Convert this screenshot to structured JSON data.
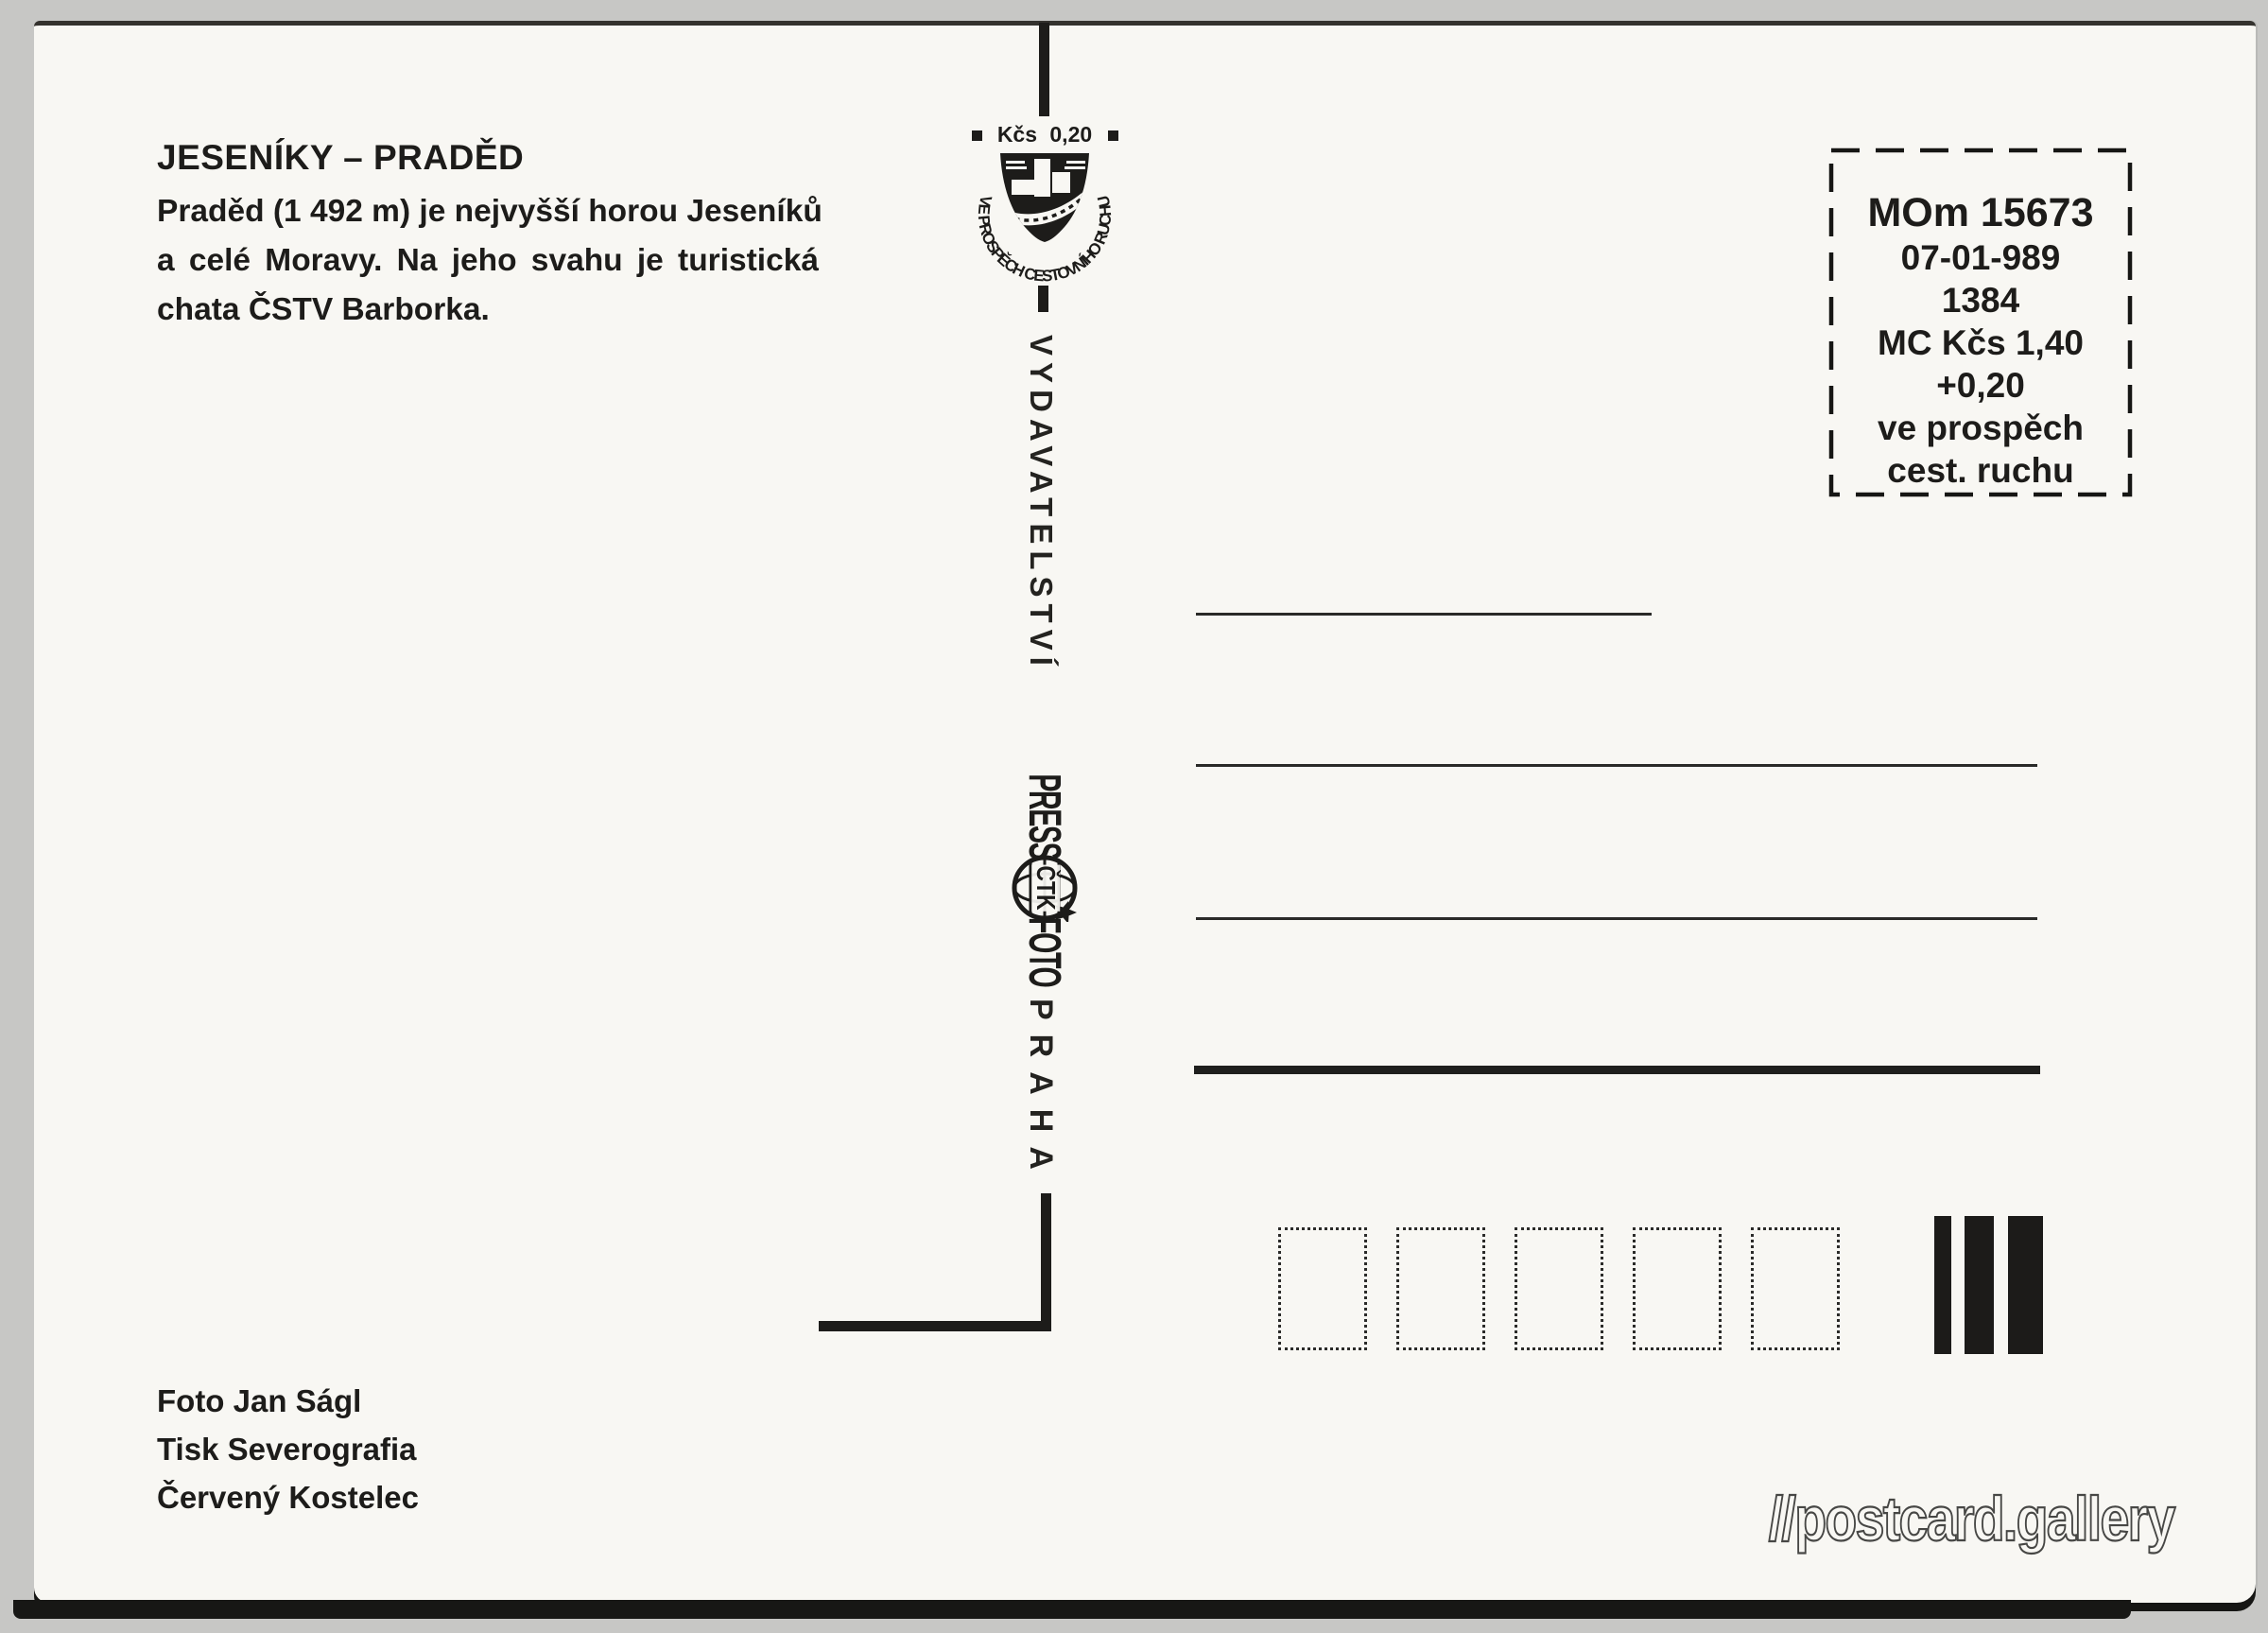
{
  "postcard": {
    "title": "JESENÍKY – PRADĚD",
    "description_lines": [
      "Praděd (1 492 m) je nejvyšší horou Jeseníků",
      "a celé Moravy. Na jeho svahu je turistická",
      "chata ČSTV Barborka."
    ],
    "credits": [
      "Foto Jan Ságl",
      "Tisk Severografia",
      "Červený Kostelec"
    ],
    "divider": {
      "stamp": {
        "value": "Kčs 0,20",
        "arc_text": "VE PROSPĚCH CESTOVNÍHO RUCHU"
      },
      "publisher": "VYDAVATELSTVÍ",
      "press_logo": {
        "press": "PRESS",
        "ctk": "ČTK",
        "foto": "FOTO"
      },
      "city": "PRAHA"
    },
    "franking_box": {
      "lines": [
        "MOm 15673",
        "07-01-989",
        "1384",
        "MC Kčs 1,40",
        "+0,20",
        "ve prospěch",
        "cest. ruchu"
      ]
    },
    "watermark": "//postcard.gallery"
  },
  "colors": {
    "ink": "#1d1c1a",
    "card": "#f8f7f3",
    "scanner_background": "#c7c7c5"
  }
}
